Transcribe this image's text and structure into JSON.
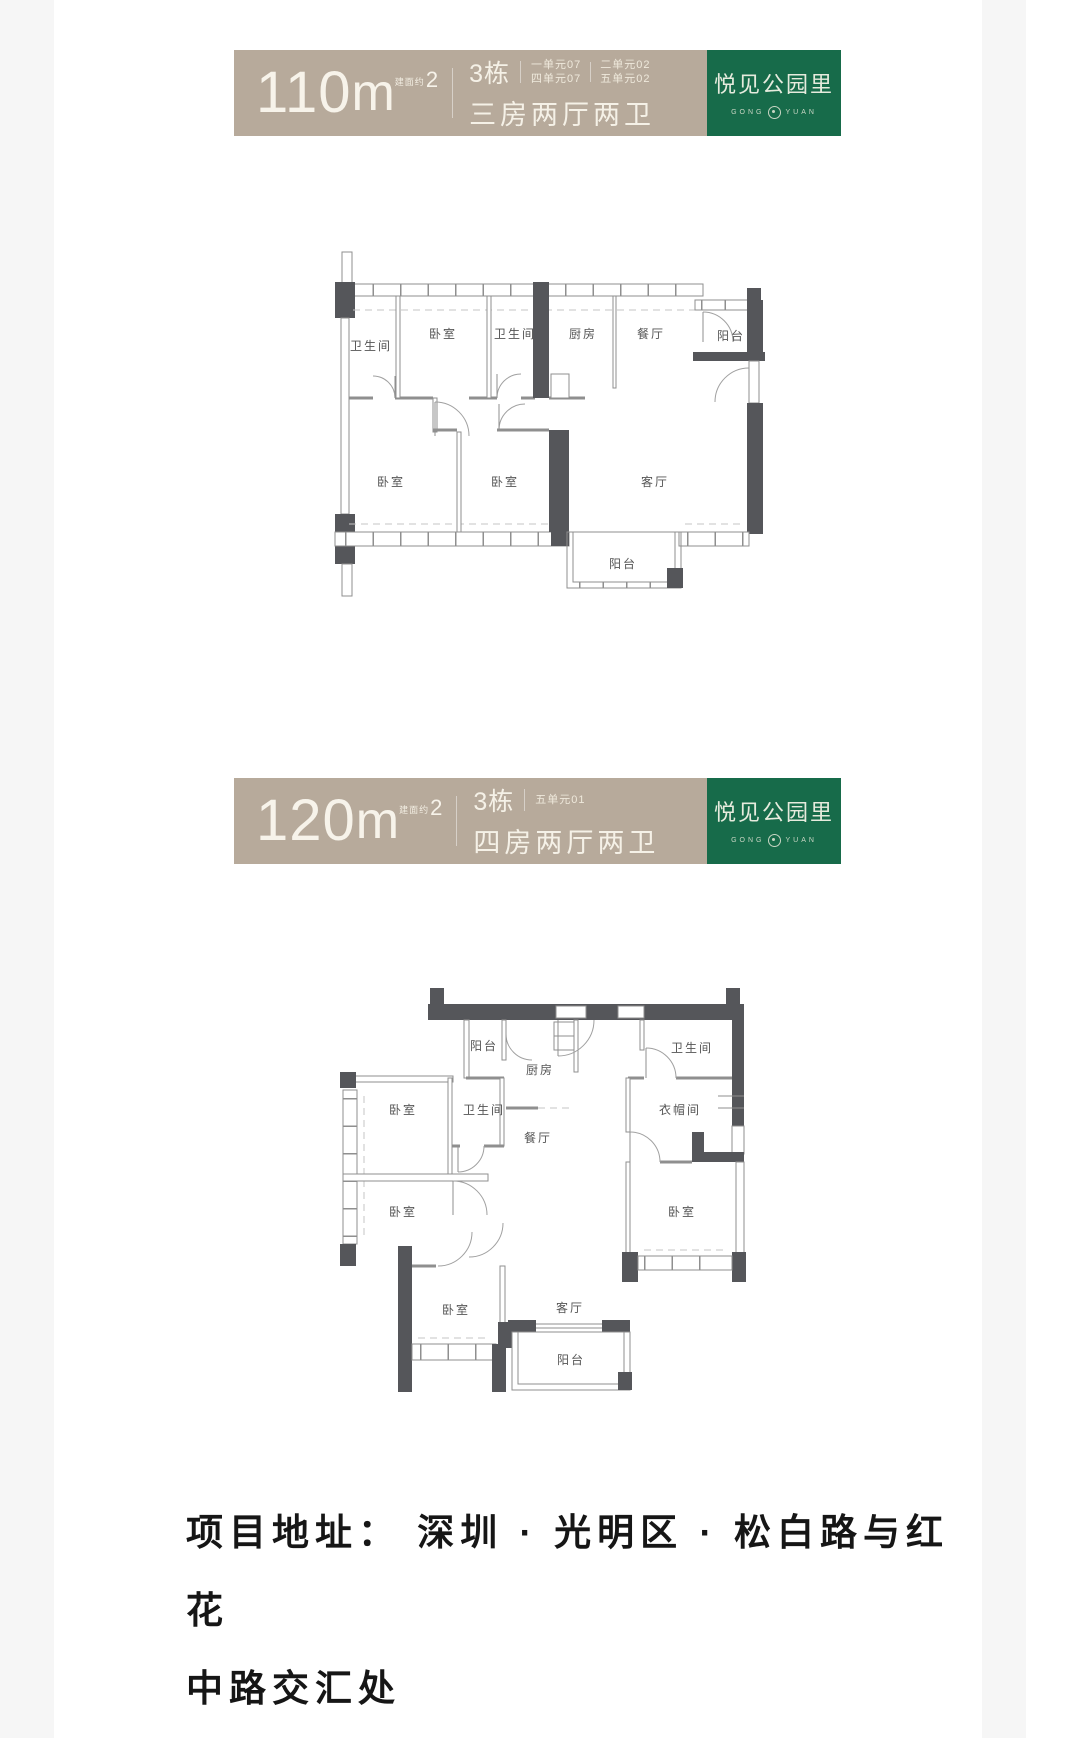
{
  "brand": {
    "name": "悦见公园里",
    "sub_left": "GONG",
    "sub_right": "YUAN",
    "green": "#176b4a",
    "tan": "#b7aa9b"
  },
  "banners": [
    {
      "area_value": "110",
      "area_unit": "m",
      "area_prefix": "建面约",
      "area_sup": "2",
      "building": "3栋",
      "unit_col1": [
        "一单元07",
        "四单元07"
      ],
      "unit_col2": [
        "二单元02",
        "五单元02"
      ],
      "layout_name": "三房两厅两卫"
    },
    {
      "area_value": "120",
      "area_unit": "m",
      "area_prefix": "建面约",
      "area_sup": "2",
      "building": "3栋",
      "unit_col1": [
        "五单元01"
      ],
      "layout_name": "四房两厅两卫"
    }
  ],
  "floorplans": [
    {
      "title": "110m2 三房两厅两卫",
      "rooms": [
        "卫生间",
        "卧室",
        "卫生间",
        "厨房",
        "餐厅",
        "阳台",
        "卧室",
        "卧室",
        "客厅",
        "阳台"
      ]
    },
    {
      "title": "120m2 四房两厅两卫",
      "rooms": [
        "阳台",
        "厨房",
        "卫生间",
        "卧室",
        "卫生间",
        "餐厅",
        "衣帽间",
        "卧室",
        "卧室",
        "卧室",
        "客厅",
        "阳台"
      ]
    }
  ],
  "address": {
    "line1": "项目地址： 深圳 · 光明区 · 松白路与红花",
    "line2": "中路交汇处"
  }
}
